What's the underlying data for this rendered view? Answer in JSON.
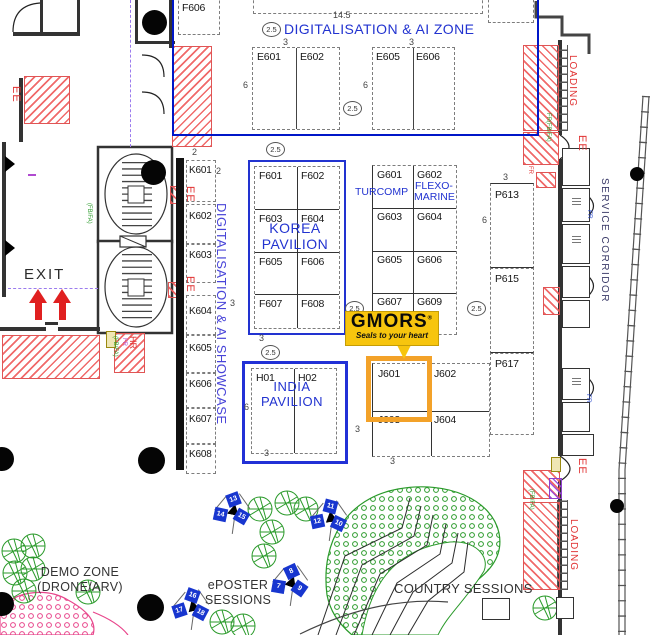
{
  "zones": {
    "ai_zone": "DIGITALISATION & AI ZONE",
    "ai_showcase": "DIGITALISATION & AI SHOWCASE",
    "korea_line1": "KOREA",
    "korea_line2": "PAVILION",
    "india_line1": "INDIA",
    "india_line2": "PAVILION",
    "demo_line1": "DEMO ZONE",
    "demo_line2": "(DRONE/ARV)",
    "eposter_line1": "ePOSTER",
    "eposter_line2": "SESSIONS",
    "country_sessions": "COUNTRY SESSIONS",
    "service_corridor": "SERVICE CORRIDOR",
    "loading": "LOADING",
    "exit": "EXIT"
  },
  "booths": {
    "e_row": [
      "E601",
      "E602",
      "E605",
      "E606"
    ],
    "f_grid": [
      "F601",
      "F602",
      "F603",
      "F604",
      "F605",
      "F606",
      "F607",
      "F608"
    ],
    "f_partial": "F606",
    "g_grid": [
      "G601",
      "G602",
      "G603",
      "G604",
      "G605",
      "G606",
      "G607",
      "G609"
    ],
    "k_col": [
      "K601",
      "K602",
      "K603",
      "K604",
      "K605",
      "K606",
      "K607",
      "K608"
    ],
    "p_col": [
      "P613",
      "P615",
      "P617"
    ],
    "j_grid": [
      "J601",
      "J602",
      "J603",
      "J604"
    ],
    "h_row": [
      "H01",
      "H02"
    ]
  },
  "exhibitors": {
    "turcomp": "TURCOMP",
    "flexo_line1": "FLEXO-",
    "flexo_line2": "MARINE"
  },
  "logo": {
    "name": "GMORS",
    "mark": "®",
    "tagline": "Seals to your heart",
    "highlight_booth": "J601"
  },
  "dims": {
    "d145": "14.5",
    "d25": "2.5",
    "d3": "3",
    "d6": "6",
    "d2": "2"
  },
  "annotations": {
    "ee": "EE",
    "fr": "FR",
    "hr": "HR",
    "fbfa": "(FB/FA)",
    "frfbfa": "FR(FB/FA)"
  },
  "markers": {
    "clusters": [
      {
        "nums": [
          "13",
          "14",
          "15"
        ]
      },
      {
        "nums": [
          "11",
          "12",
          "10"
        ]
      },
      {
        "nums": [
          "8",
          "7",
          "9"
        ]
      },
      {
        "nums": [
          "16",
          "17",
          "18"
        ]
      }
    ]
  },
  "colors": {
    "zone_blue": "#2233d0",
    "showcase_blue": "#4844d8",
    "red": "#e03030",
    "tree_green": "#2a9a2a",
    "hedge_pink": "#e8458b",
    "gmors_yellow": "#f7c50e",
    "highlight_orange": "#f3a229",
    "marker_blue": "#1836cf",
    "corridor_navy": "#3a3a68",
    "boundary_blue": "#0017c8",
    "purple_dashed": "#9b7bee"
  }
}
